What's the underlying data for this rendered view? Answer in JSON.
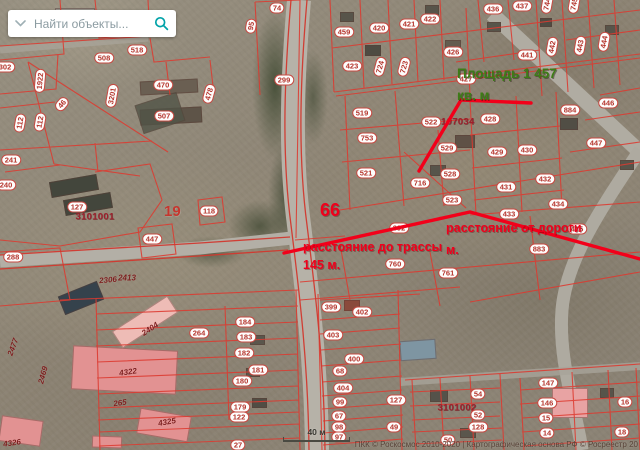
{
  "search": {
    "placeholder": "Найти объекты..."
  },
  "annotations": {
    "area_line1": "Площадь 1 457",
    "area_line2": "кв. м",
    "highway_line1": "расстояние до трассы",
    "highway_line2": "145 м.",
    "road_line1": "расстояние от дороги",
    "road_line2": "м.",
    "parcel_big": "66",
    "district": "19"
  },
  "scalebar": {
    "label": "40 м"
  },
  "attribution": "ПКК © Роскосмос 2010-2020 | Картографическая основа РФ © Росреестр 20",
  "colors": {
    "accent_teal": "#00a2a8",
    "parcel_line": "#dd3a30",
    "measure_red": "#f2001a",
    "area_green": "#3d7c16",
    "annotation_red": "#ef001c"
  },
  "map": {
    "quarters": [
      {
        "t": "3101001",
        "x": 95,
        "y": 217
      },
      {
        "t": "3107034",
        "x": 455,
        "y": 122
      },
      {
        "t": "3101002",
        "x": 457,
        "y": 408
      }
    ],
    "building_labels": [
      {
        "t": "2306",
        "x": 108,
        "y": 280,
        "r": -5
      },
      {
        "t": "2413",
        "x": 127,
        "y": 278
      },
      {
        "t": "2404",
        "x": 150,
        "y": 329,
        "r": -33
      },
      {
        "t": "2477",
        "x": 13,
        "y": 347,
        "r": -70
      },
      {
        "t": "2469",
        "x": 43,
        "y": 375,
        "r": -75
      },
      {
        "t": "4322",
        "x": 128,
        "y": 372,
        "r": -8
      },
      {
        "t": "265",
        "x": 120,
        "y": 403,
        "r": -8
      },
      {
        "t": "4325",
        "x": 167,
        "y": 422,
        "r": -10
      },
      {
        "t": "4326",
        "x": 12,
        "y": 443,
        "r": -8
      }
    ],
    "badges": [
      {
        "t": "74",
        "x": 277,
        "y": 8
      },
      {
        "t": "95",
        "x": 251,
        "y": 26,
        "r": -80
      },
      {
        "t": "299",
        "x": 284,
        "y": 80
      },
      {
        "t": "459",
        "x": 344,
        "y": 32
      },
      {
        "t": "420",
        "x": 379,
        "y": 28
      },
      {
        "t": "421",
        "x": 409,
        "y": 24
      },
      {
        "t": "422",
        "x": 430,
        "y": 19
      },
      {
        "t": "423",
        "x": 352,
        "y": 66
      },
      {
        "t": "724",
        "x": 380,
        "y": 67,
        "r": -75
      },
      {
        "t": "723",
        "x": 404,
        "y": 67,
        "r": -75
      },
      {
        "t": "436",
        "x": 493,
        "y": 9
      },
      {
        "t": "437",
        "x": 522,
        "y": 6
      },
      {
        "t": "426",
        "x": 453,
        "y": 52
      },
      {
        "t": "441",
        "x": 527,
        "y": 55
      },
      {
        "t": "744",
        "x": 547,
        "y": 4,
        "r": -80
      },
      {
        "t": "745",
        "x": 574,
        "y": 4,
        "r": -80
      },
      {
        "t": "442",
        "x": 552,
        "y": 47,
        "r": -80
      },
      {
        "t": "443",
        "x": 580,
        "y": 46,
        "r": -80
      },
      {
        "t": "444",
        "x": 604,
        "y": 42,
        "r": -80
      },
      {
        "t": "427",
        "x": 466,
        "y": 79
      },
      {
        "t": "428",
        "x": 490,
        "y": 119
      },
      {
        "t": "884",
        "x": 570,
        "y": 110
      },
      {
        "t": "446",
        "x": 608,
        "y": 103
      },
      {
        "t": "519",
        "x": 362,
        "y": 113
      },
      {
        "t": "522",
        "x": 431,
        "y": 122
      },
      {
        "t": "753",
        "x": 367,
        "y": 138
      },
      {
        "t": "529",
        "x": 447,
        "y": 148
      },
      {
        "t": "521",
        "x": 366,
        "y": 173
      },
      {
        "t": "716",
        "x": 420,
        "y": 183
      },
      {
        "t": "528",
        "x": 450,
        "y": 174
      },
      {
        "t": "429",
        "x": 497,
        "y": 152
      },
      {
        "t": "430",
        "x": 527,
        "y": 150
      },
      {
        "t": "431",
        "x": 506,
        "y": 187
      },
      {
        "t": "432",
        "x": 545,
        "y": 179
      },
      {
        "t": "434",
        "x": 558,
        "y": 204
      },
      {
        "t": "447",
        "x": 596,
        "y": 143
      },
      {
        "t": "523",
        "x": 452,
        "y": 200
      },
      {
        "t": "433",
        "x": 509,
        "y": 214
      },
      {
        "t": "415",
        "x": 577,
        "y": 229
      },
      {
        "t": "883",
        "x": 539,
        "y": 249
      },
      {
        "t": "392",
        "x": 399,
        "y": 228
      },
      {
        "t": "760",
        "x": 395,
        "y": 264
      },
      {
        "t": "761",
        "x": 448,
        "y": 273
      },
      {
        "t": "302",
        "x": 5,
        "y": 67
      },
      {
        "t": "1922",
        "x": 40,
        "y": 81,
        "r": -85
      },
      {
        "t": "508",
        "x": 104,
        "y": 58
      },
      {
        "t": "518",
        "x": 137,
        "y": 50
      },
      {
        "t": "3201",
        "x": 112,
        "y": 96,
        "r": -80
      },
      {
        "t": "470",
        "x": 163,
        "y": 85
      },
      {
        "t": "507",
        "x": 164,
        "y": 116
      },
      {
        "t": "478",
        "x": 209,
        "y": 94,
        "r": -75
      },
      {
        "t": "112",
        "x": 20,
        "y": 123,
        "r": -80
      },
      {
        "t": "112",
        "x": 40,
        "y": 122,
        "r": -80
      },
      {
        "t": "46",
        "x": 62,
        "y": 104,
        "r": -50
      },
      {
        "t": "241",
        "x": 11,
        "y": 160
      },
      {
        "t": "240",
        "x": 6,
        "y": 185
      },
      {
        "t": "127",
        "x": 77,
        "y": 207
      },
      {
        "t": "118",
        "x": 209,
        "y": 211
      },
      {
        "t": "447",
        "x": 152,
        "y": 239
      },
      {
        "t": "288",
        "x": 13,
        "y": 257
      },
      {
        "t": "264",
        "x": 199,
        "y": 333
      },
      {
        "t": "184",
        "x": 245,
        "y": 322
      },
      {
        "t": "183",
        "x": 246,
        "y": 337
      },
      {
        "t": "182",
        "x": 244,
        "y": 353
      },
      {
        "t": "181",
        "x": 258,
        "y": 370
      },
      {
        "t": "180",
        "x": 242,
        "y": 381
      },
      {
        "t": "179",
        "x": 240,
        "y": 407
      },
      {
        "t": "122",
        "x": 239,
        "y": 417
      },
      {
        "t": "27",
        "x": 238,
        "y": 445
      },
      {
        "t": "399",
        "x": 331,
        "y": 307
      },
      {
        "t": "402",
        "x": 362,
        "y": 312
      },
      {
        "t": "403",
        "x": 333,
        "y": 335
      },
      {
        "t": "400",
        "x": 354,
        "y": 359
      },
      {
        "t": "68",
        "x": 340,
        "y": 371
      },
      {
        "t": "404",
        "x": 343,
        "y": 388
      },
      {
        "t": "99",
        "x": 340,
        "y": 402
      },
      {
        "t": "67",
        "x": 339,
        "y": 416
      },
      {
        "t": "98",
        "x": 339,
        "y": 427
      },
      {
        "t": "97",
        "x": 339,
        "y": 437
      },
      {
        "t": "127",
        "x": 396,
        "y": 400
      },
      {
        "t": "49",
        "x": 394,
        "y": 427
      },
      {
        "t": "54",
        "x": 478,
        "y": 394
      },
      {
        "t": "52",
        "x": 478,
        "y": 415
      },
      {
        "t": "128",
        "x": 478,
        "y": 427
      },
      {
        "t": "50",
        "x": 448,
        "y": 440
      },
      {
        "t": "147",
        "x": 548,
        "y": 383
      },
      {
        "t": "146",
        "x": 547,
        "y": 403
      },
      {
        "t": "15",
        "x": 546,
        "y": 418
      },
      {
        "t": "14",
        "x": 547,
        "y": 433
      },
      {
        "t": "16",
        "x": 625,
        "y": 402
      },
      {
        "t": "18",
        "x": 622,
        "y": 432
      }
    ]
  }
}
